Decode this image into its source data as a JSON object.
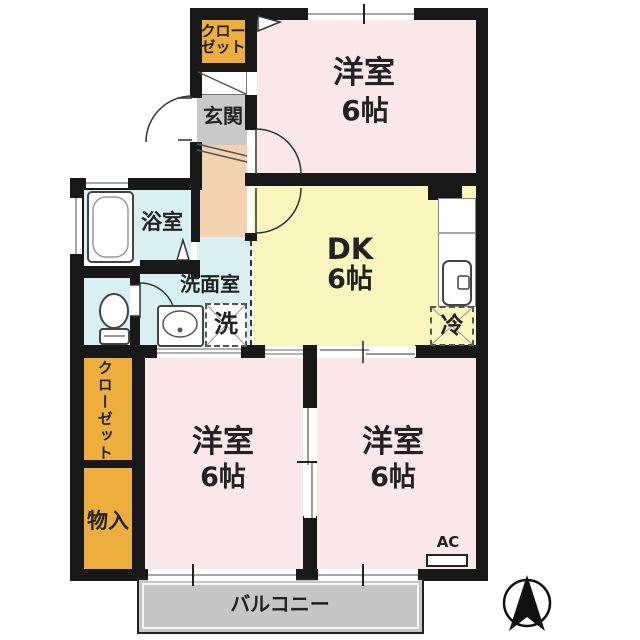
{
  "title": "apartment-floor-plan",
  "colors": {
    "bedroom_pink": "#f9e7e9",
    "dk_yellow": "#f8f6bd",
    "closet_orange": "#eeae3e",
    "wet_area_blue": "#d8f0f1",
    "hall_peach": "#f2d2b0",
    "entrance_gray": "#c9c9c9",
    "balcony_gray": "#c6c6c6",
    "wall_black": "#181818"
  },
  "rooms": {
    "top_bedroom": {
      "name": "洋室",
      "size": "6帖"
    },
    "dk": {
      "name": "DK",
      "size": "6帖"
    },
    "bottom_left_bedroom": {
      "name": "洋室",
      "size": "6帖"
    },
    "bottom_right_bedroom": {
      "name": "洋室",
      "size": "6帖"
    },
    "bathroom": {
      "name": "浴室"
    },
    "washroom": {
      "name": "洗面室"
    },
    "entrance": {
      "name": "玄関"
    },
    "closet_top": {
      "name": "クローゼット",
      "line1": "クロー",
      "line2": "ゼット"
    },
    "closet_left": {
      "name": "クローゼット"
    },
    "storage": {
      "name": "物入"
    },
    "balcony": {
      "name": "バルコニー"
    }
  },
  "fixtures": {
    "washing_machine": "洗",
    "refrigerator": "冷",
    "air_conditioner": "AC"
  },
  "icons": [
    "bathtub-icon",
    "toilet-icon",
    "washbasin-icon",
    "kitchen-sink-icon",
    "north-arrow-icon"
  ]
}
